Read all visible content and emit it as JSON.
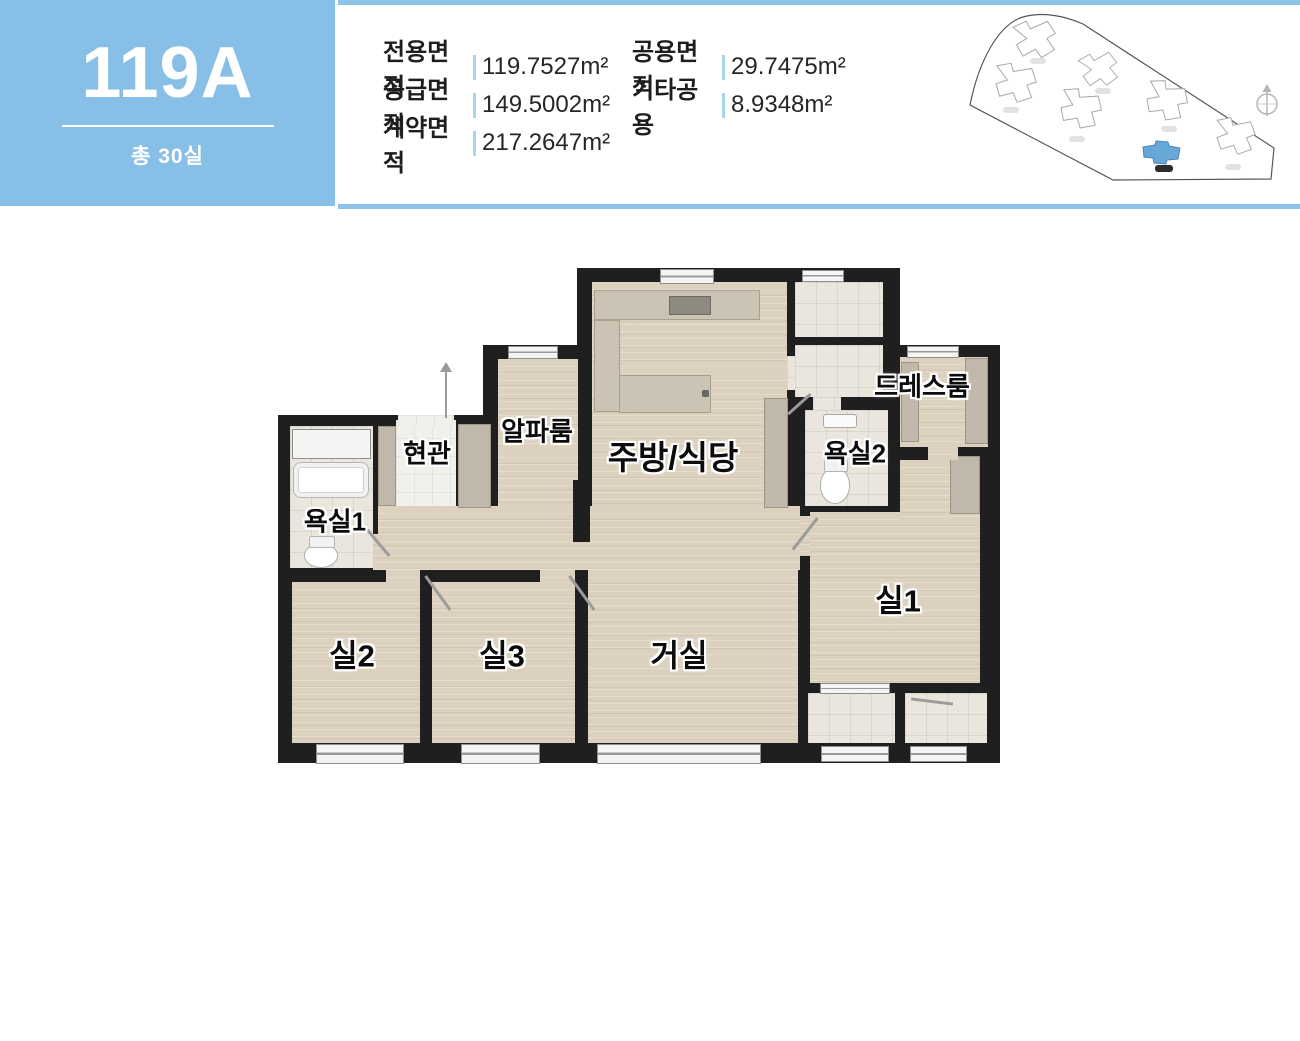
{
  "unit": {
    "code": "119A",
    "total_units": "총 30실"
  },
  "areas": {
    "col1": [
      {
        "label": "전용면적",
        "value": "119.7527m²"
      },
      {
        "label": "공급면적",
        "value": "149.5002m²"
      },
      {
        "label": "계약면적",
        "value": "217.2647m²"
      }
    ],
    "col2": [
      {
        "label": "공용면적",
        "value": "29.7475m²"
      },
      {
        "label": "기타공용",
        "value": "8.9348m²"
      }
    ]
  },
  "floor_plan": {
    "rooms": {
      "kitchen": "주방/식당",
      "dress": "드레스룸",
      "bath2": "욕실2",
      "bath1": "욕실1",
      "entrance": "현관",
      "alpha": "알파룸",
      "room1": "실1",
      "room2": "실2",
      "room3": "실3",
      "living": "거실"
    }
  },
  "site_plan": {
    "boundary_path": "M5,93 C14,48 34,12 58,5 C76,0 97,3 118,12 L309,136 L306,167 L148,168 Z",
    "building_path": "M-22,-16 L-8,-20 L-5,-12 L13,-17 L19,-4 L10,0 L16,12 L2,18 L-3,9 L-16,14 L-21,2 L-10,-3 Z",
    "highlight_path": "M-20,-7 L-8,-9 L-7,-13 L5,-12 L6,-8 L17,-6 L15,5 L4,6 L3,10 L-9,9 L-10,4 L-19,3 Z",
    "buildings": [
      {
        "x": 72,
        "y": 28,
        "r": -8,
        "s": 1,
        "lx": 65,
        "ly": 46,
        "highlighted": false
      },
      {
        "x": 52,
        "y": 72,
        "r": 6,
        "s": 1,
        "lx": 38,
        "ly": 95,
        "highlighted": false
      },
      {
        "x": 117,
        "y": 98,
        "r": 12,
        "s": 1,
        "lx": 104,
        "ly": 124,
        "highlighted": false
      },
      {
        "x": 136,
        "y": 58,
        "r": -14,
        "s": 0.9,
        "lx": 130,
        "ly": 76,
        "highlighted": false
      },
      {
        "x": 203,
        "y": 90,
        "r": 14,
        "s": 1,
        "lx": 196,
        "ly": 114,
        "highlighted": false
      },
      {
        "x": 272,
        "y": 125,
        "r": 4,
        "s": 0.95,
        "lx": 260,
        "ly": 152,
        "highlighted": false
      },
      {
        "x": 198,
        "y": 142,
        "r": 0,
        "s": 1,
        "lx": 190,
        "ly": 153,
        "highlighted": true
      }
    ]
  },
  "colors": {
    "accent_blue": "#87BFE7",
    "bar_blue": "#8CC3E9",
    "sep_blue": "#A9D3EF",
    "wall": "#1F1F1F",
    "hl_building": "#68A8D8"
  }
}
